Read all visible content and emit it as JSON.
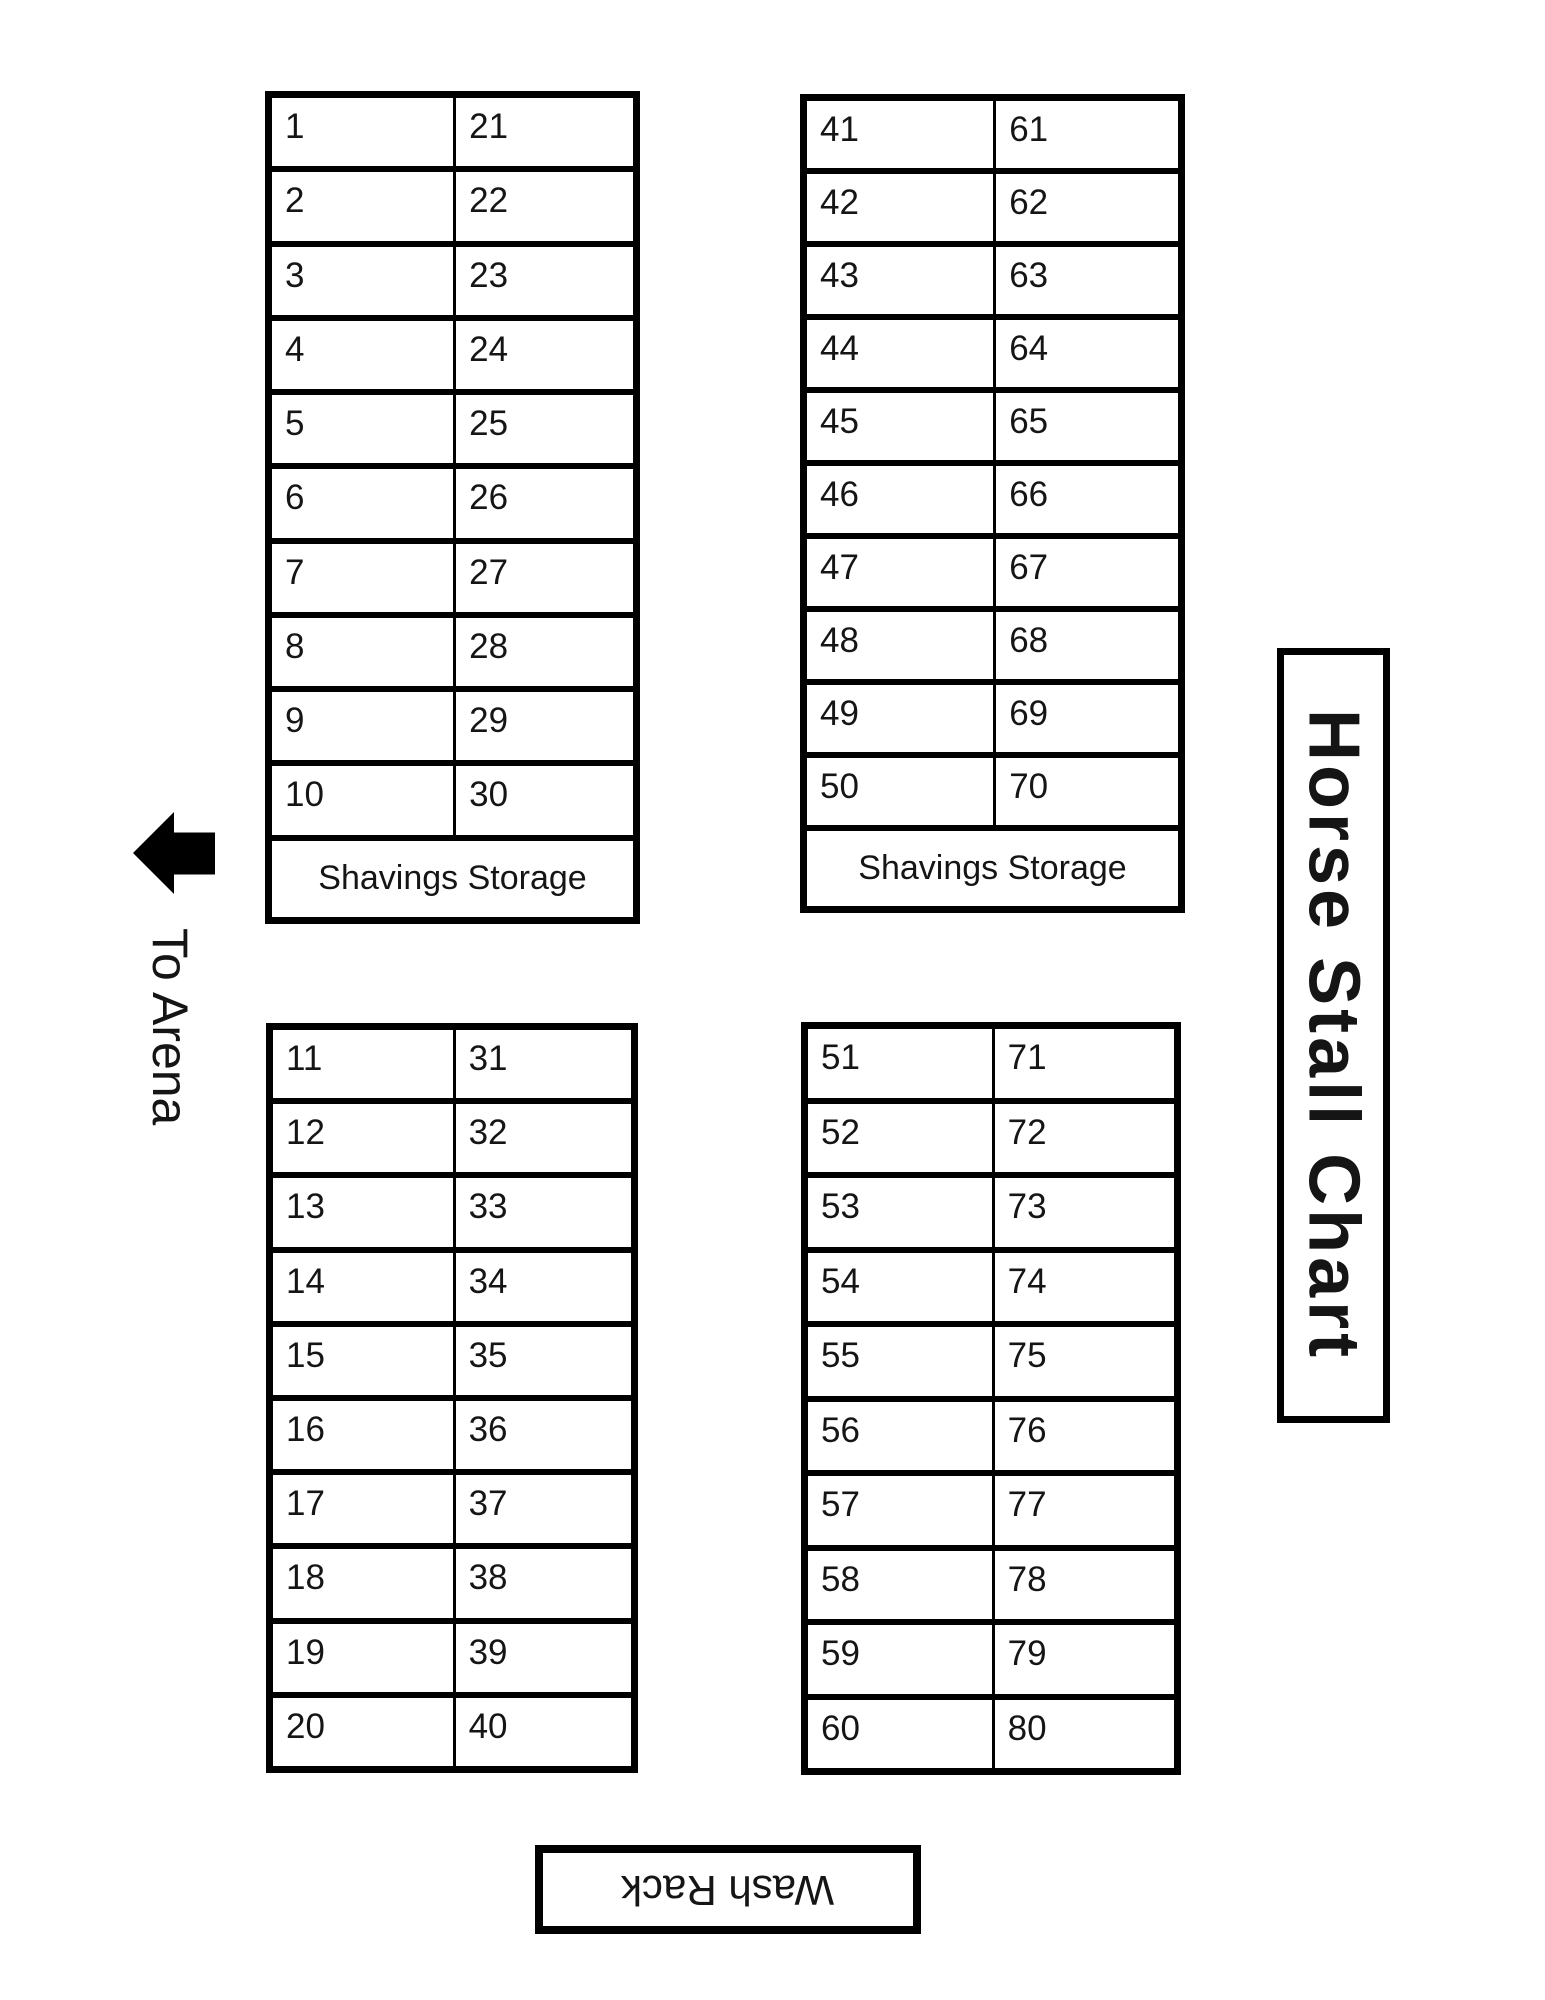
{
  "title": "Horse Stall Chart",
  "labels": {
    "to_arena": "To Arena",
    "wash_rack": "Wash Rack",
    "shavings_storage": "Shavings Storage"
  },
  "icons": {
    "arena_direction": "left-arrow-icon"
  },
  "colors": {
    "border": "#000000",
    "background": "#ffffff",
    "text": "#151515"
  },
  "blocks": [
    {
      "name": "top-left",
      "left_column": [
        "1",
        "2",
        "3",
        "4",
        "5",
        "6",
        "7",
        "8",
        "9",
        "10"
      ],
      "right_column": [
        "21",
        "22",
        "23",
        "24",
        "25",
        "26",
        "27",
        "28",
        "29",
        "30"
      ],
      "storage_label": "Shavings Storage"
    },
    {
      "name": "top-right",
      "left_column": [
        "41",
        "42",
        "43",
        "44",
        "45",
        "46",
        "47",
        "48",
        "49",
        "50"
      ],
      "right_column": [
        "61",
        "62",
        "63",
        "64",
        "65",
        "66",
        "67",
        "68",
        "69",
        "70"
      ],
      "storage_label": "Shavings Storage"
    },
    {
      "name": "bottom-left",
      "left_column": [
        "11",
        "12",
        "13",
        "14",
        "15",
        "16",
        "17",
        "18",
        "19",
        "20"
      ],
      "right_column": [
        "31",
        "32",
        "33",
        "34",
        "35",
        "36",
        "37",
        "38",
        "39",
        "40"
      ]
    },
    {
      "name": "bottom-right",
      "left_column": [
        "51",
        "52",
        "53",
        "54",
        "55",
        "56",
        "57",
        "58",
        "59",
        "60"
      ],
      "right_column": [
        "71",
        "72",
        "73",
        "74",
        "75",
        "76",
        "77",
        "78",
        "79",
        "80"
      ]
    }
  ]
}
